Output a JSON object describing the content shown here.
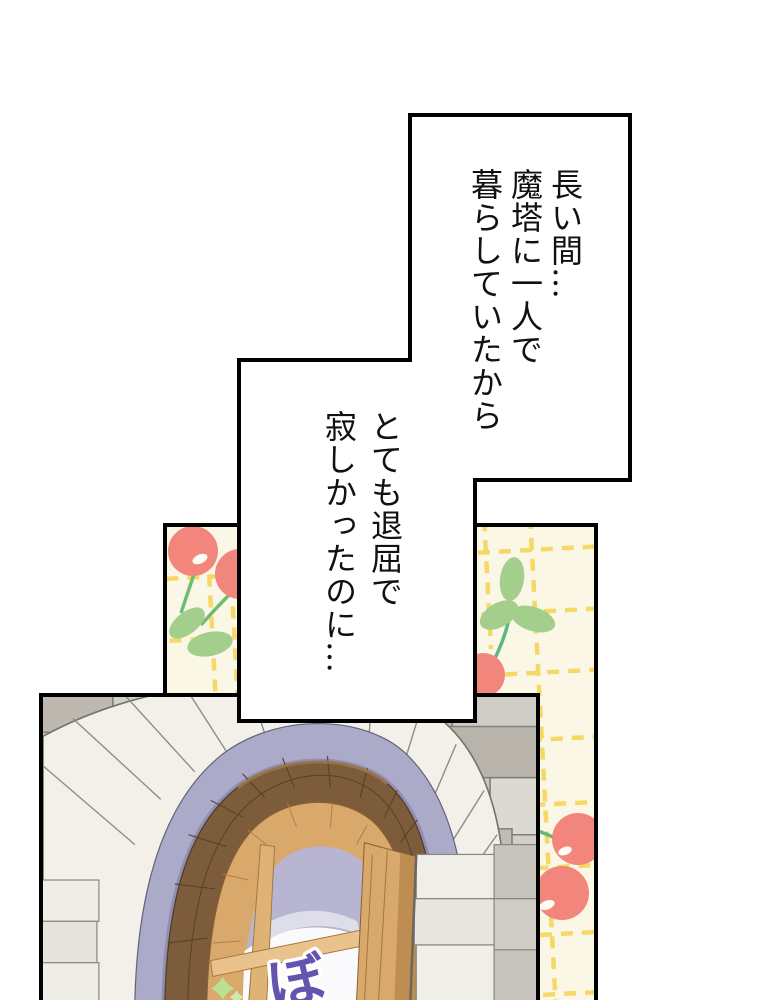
{
  "page": {
    "kind": "webtoon-comic-panel",
    "background": "#ffffff",
    "width": 760,
    "height": 1000
  },
  "speech_bubbles": [
    {
      "id": "bubble-1",
      "shape": "stepped-rectangle",
      "writing": "vertical-right-to-left",
      "lines": [
        "長い間…",
        "魔塔に一人で",
        "暮らしていたから"
      ]
    },
    {
      "id": "bubble-2",
      "shape": "stepped-rectangle",
      "writing": "vertical-right-to-left",
      "lines": [
        "とても退屈で",
        "寂しかったのに…"
      ]
    }
  ],
  "sound_effect": {
    "text": "ぼ",
    "color": "#6554AE",
    "outline": "#FFFFFF"
  },
  "artwork": {
    "outline": "#000000",
    "wallpaper": {
      "background": "#FBF7E7",
      "cherry_red": "#F2857C",
      "cherry_highlight": "#FFFDF3",
      "leaf_green": "#A3CE8C",
      "stem_green": "#6FBC72",
      "dash_yellow": "#F5D75F"
    },
    "stone_wall": {
      "stone_gray": "#CDCAC3",
      "voussoir_white": "#F2F0E9",
      "arch_trim_lavender": "#ABAAC8",
      "arch_brick_brown": "#7D5C3B",
      "window_wood": "#D9A96B",
      "glass_lavender": "#B7B5D1",
      "glass_white": "#FAFAFC",
      "sparkle_green": "#B9E192"
    }
  }
}
